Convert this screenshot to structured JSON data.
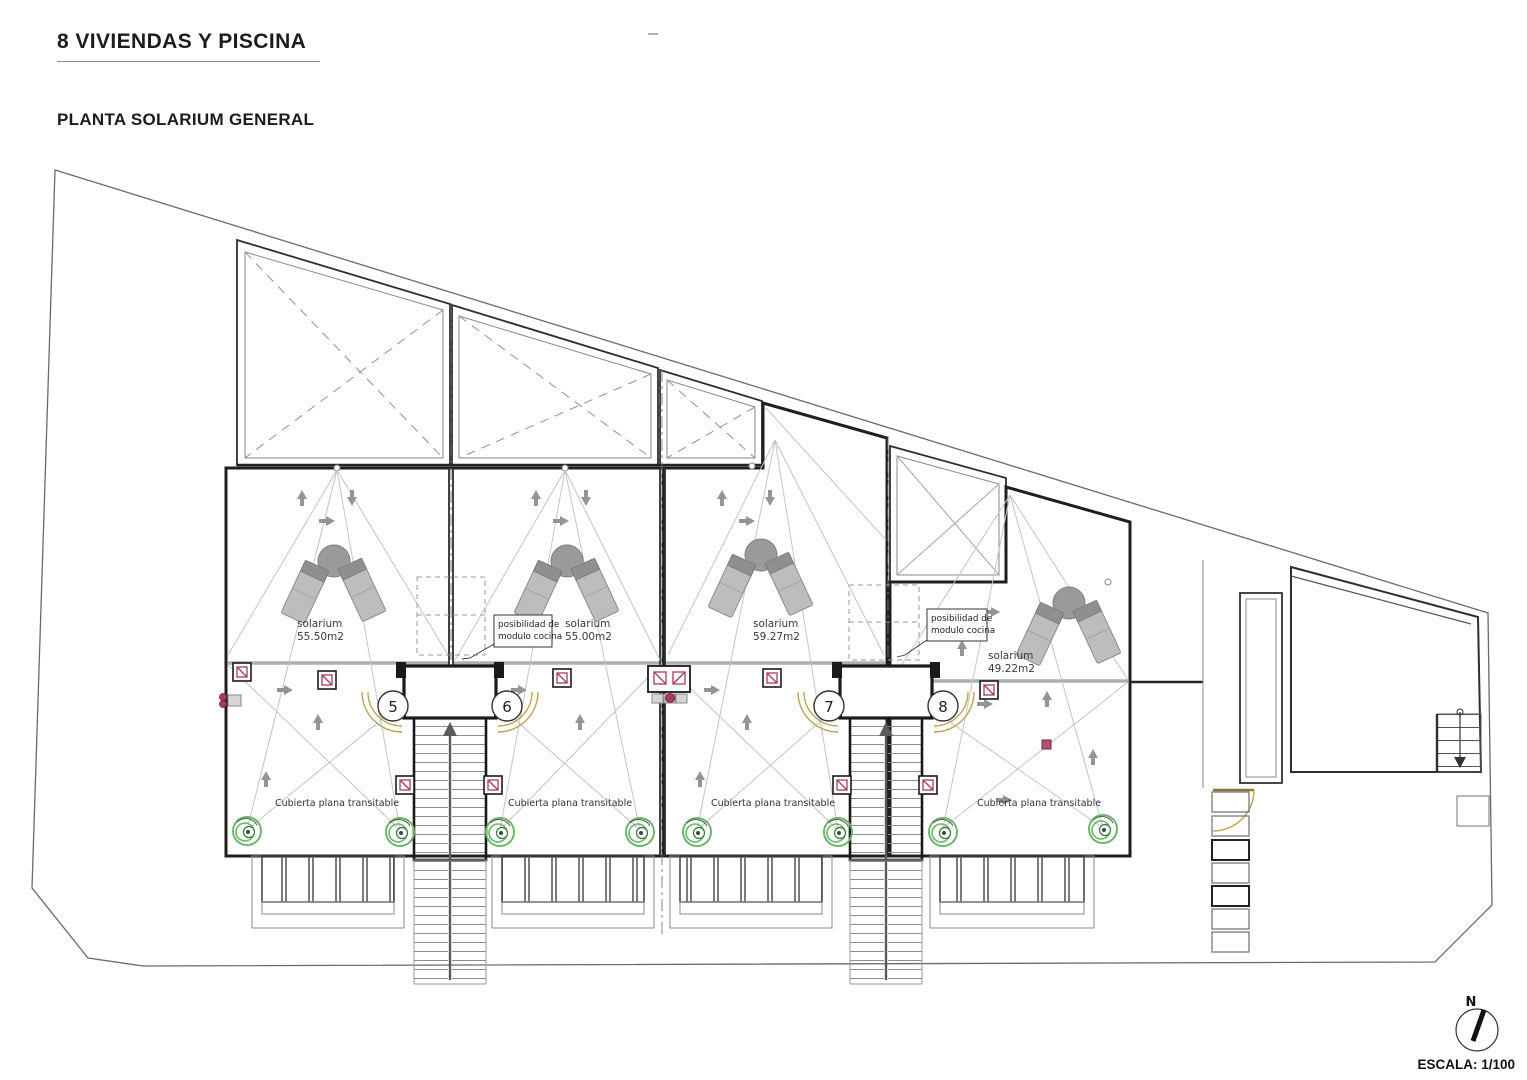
{
  "header": {
    "title": "8 VIVIENDAS Y PISCINA",
    "subtitle": "PLANTA SOLARIUM GENERAL"
  },
  "footer": {
    "scale_label": "ESCALA: 1/100",
    "north_label": "N"
  },
  "units": [
    {
      "number": "5",
      "solarium_label": "solarium",
      "area_label": "55.50m2",
      "roof_label": "Cubierta plana transitable"
    },
    {
      "number": "6",
      "solarium_label": "solarium",
      "area_label": "55.00m2",
      "roof_label": "Cubierta plana transitable"
    },
    {
      "number": "7",
      "solarium_label": "solarium",
      "area_label": "59.27m2",
      "roof_label": "Cubierta plana transitable"
    },
    {
      "number": "8",
      "solarium_label": "solarium",
      "area_label": "49.22m2",
      "roof_label": "Cubierta plana transitable"
    }
  ],
  "annotations": {
    "kitchen_note_line1": "posibilidad de",
    "kitchen_note_line2": "modulo cocina"
  },
  "colors": {
    "accent_red": "#a63d57",
    "drain_green": "#5fae5f",
    "door_tan": "#bfa254",
    "wall_dark": "#1f1f1f",
    "tile_grid": "#d9d9d9"
  }
}
